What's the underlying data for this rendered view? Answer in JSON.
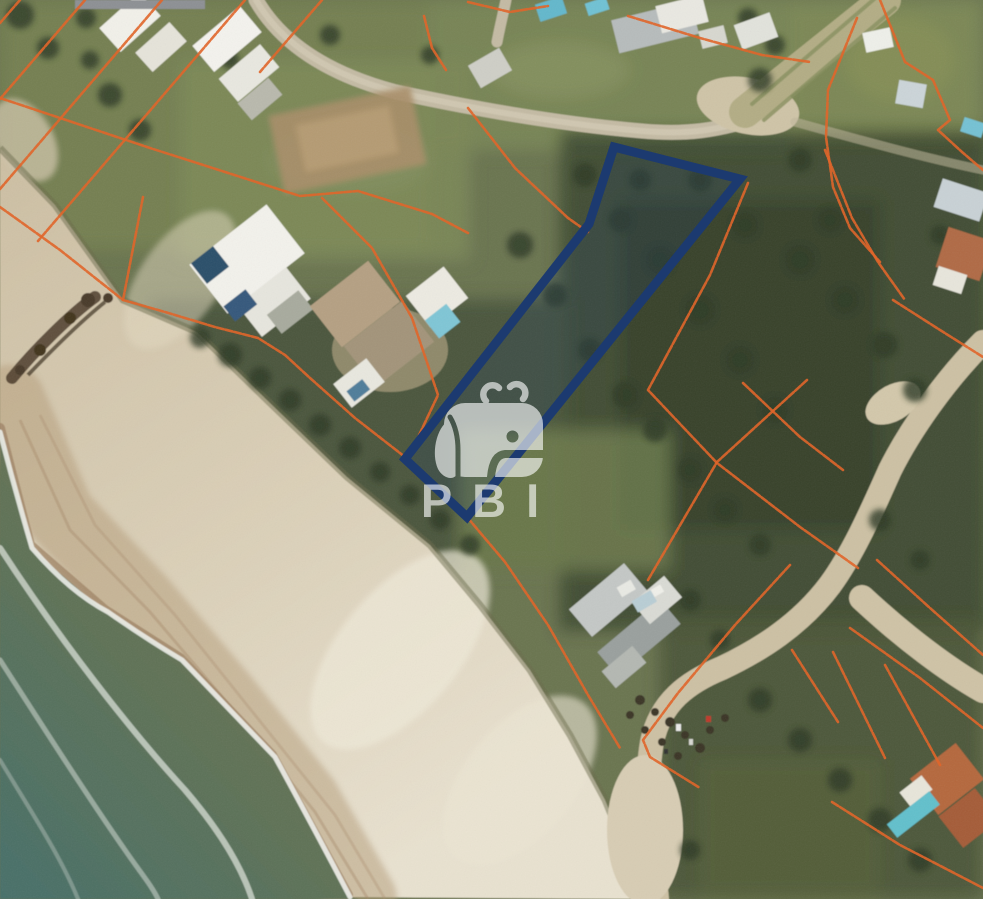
{
  "watermark": {
    "brand_text": "PBI",
    "logo": "whale-icon",
    "color": "#ffffff",
    "opacity": 0.62,
    "font_size_px": 47,
    "letter_spacing_px": 20,
    "center_x": 490,
    "text_baseline_y": 517
  },
  "parcel_overlay": {
    "highlight_parcel": {
      "stroke_color": "#1c3a70",
      "stroke_width": 9,
      "fill_color": "#1c3a70",
      "fill_opacity": 0.2,
      "points": [
        [
          614,
          147
        ],
        [
          740,
          179
        ],
        [
          467,
          517
        ],
        [
          405,
          459
        ],
        [
          589,
          224
        ]
      ]
    },
    "cadastral_lines": {
      "color": "#e0662b",
      "stroke_width": 2.6,
      "opacity": 0.9,
      "polylines": [
        [
          [
            20,
            0
          ],
          [
            0,
            23
          ]
        ],
        [
          [
            85,
            0
          ],
          [
            0,
            99
          ]
        ],
        [
          [
            162,
            0
          ],
          [
            0,
            189
          ]
        ],
        [
          [
            245,
            0
          ],
          [
            38,
            241
          ]
        ],
        [
          [
            322,
            0
          ],
          [
            260,
            72
          ]
        ],
        [
          [
            424,
            16
          ],
          [
            432,
            48
          ],
          [
            446,
            70
          ]
        ],
        [
          [
            468,
            2
          ],
          [
            510,
            12
          ],
          [
            548,
            6
          ]
        ],
        [
          [
            0,
            98
          ],
          [
            150,
            148
          ],
          [
            300,
            196
          ],
          [
            358,
            191
          ],
          [
            432,
            214
          ],
          [
            468,
            233
          ]
        ],
        [
          [
            0,
            207
          ],
          [
            60,
            250
          ],
          [
            123,
            300
          ],
          [
            165,
            312
          ],
          [
            215,
            327
          ],
          [
            258,
            338
          ],
          [
            285,
            355
          ],
          [
            310,
            378
          ],
          [
            355,
            418
          ],
          [
            405,
            457
          ]
        ],
        [
          [
            123,
            300
          ],
          [
            143,
            197
          ]
        ],
        [
          [
            467,
            517
          ],
          [
            505,
            562
          ],
          [
            548,
            625
          ],
          [
            588,
            695
          ],
          [
            620,
            748
          ]
        ],
        [
          [
            322,
            198
          ],
          [
            372,
            248
          ],
          [
            412,
            318
          ],
          [
            438,
            395
          ],
          [
            412,
            450
          ]
        ],
        [
          [
            468,
            108
          ],
          [
            515,
            168
          ],
          [
            568,
            218
          ],
          [
            588,
            232
          ]
        ],
        [
          [
            628,
            16
          ],
          [
            700,
            38
          ],
          [
            762,
            55
          ],
          [
            810,
            62
          ]
        ],
        [
          [
            748,
            183
          ],
          [
            710,
            275
          ],
          [
            648,
            390
          ],
          [
            717,
            463
          ],
          [
            800,
            527
          ],
          [
            858,
            568
          ]
        ],
        [
          [
            825,
            150
          ],
          [
            852,
            218
          ],
          [
            878,
            262
          ],
          [
            905,
            300
          ]
        ],
        [
          [
            893,
            300
          ],
          [
            940,
            330
          ],
          [
            983,
            357
          ]
        ],
        [
          [
            743,
            383
          ],
          [
            800,
            437
          ],
          [
            843,
            470
          ]
        ],
        [
          [
            807,
            380
          ],
          [
            717,
            462
          ],
          [
            648,
            580
          ]
        ],
        [
          [
            857,
            18
          ],
          [
            828,
            90
          ],
          [
            826,
            137
          ],
          [
            833,
            187
          ],
          [
            850,
            228
          ],
          [
            880,
            262
          ]
        ],
        [
          [
            880,
            0
          ],
          [
            905,
            62
          ],
          [
            933,
            80
          ],
          [
            950,
            120
          ]
        ],
        [
          [
            950,
            120
          ],
          [
            938,
            130
          ],
          [
            962,
            152
          ],
          [
            983,
            170
          ]
        ],
        [
          [
            877,
            560
          ],
          [
            930,
            608
          ],
          [
            983,
            655
          ]
        ],
        [
          [
            850,
            628
          ],
          [
            920,
            678
          ],
          [
            983,
            728
          ]
        ],
        [
          [
            792,
            650
          ],
          [
            838,
            722
          ]
        ],
        [
          [
            833,
            652
          ],
          [
            885,
            758
          ]
        ],
        [
          [
            885,
            665
          ],
          [
            940,
            765
          ]
        ],
        [
          [
            832,
            802
          ],
          [
            900,
            845
          ],
          [
            983,
            888
          ]
        ],
        [
          [
            790,
            565
          ],
          [
            735,
            625
          ],
          [
            678,
            693
          ],
          [
            643,
            740
          ],
          [
            650,
            757
          ],
          [
            700,
            788
          ]
        ]
      ]
    }
  },
  "scene": {
    "type": "satellite-aerial-photo",
    "features": [
      "ocean",
      "surf",
      "beach",
      "dunes",
      "vacant-lots",
      "houses",
      "pools",
      "dirt-roads"
    ],
    "colors": {
      "ocean_deep": "#47706a",
      "ocean_shallow": "#73744f",
      "surf_foam": "#edf0ea",
      "sand_dry": "#d9cdb2",
      "sand_bright": "#e9e2d0",
      "sand_wet": "#9d8163",
      "vegetation": "#6a7450",
      "shrub_dark": "#3f4a31",
      "road_sand": "#cdc1a4",
      "roof_white": "#f2f1ec",
      "roof_gray": "#b7bcbc",
      "roof_terracotta": "#b5673e",
      "pool_blue": "#64b8cc",
      "label_bar_gray": "#8d9094"
    }
  }
}
